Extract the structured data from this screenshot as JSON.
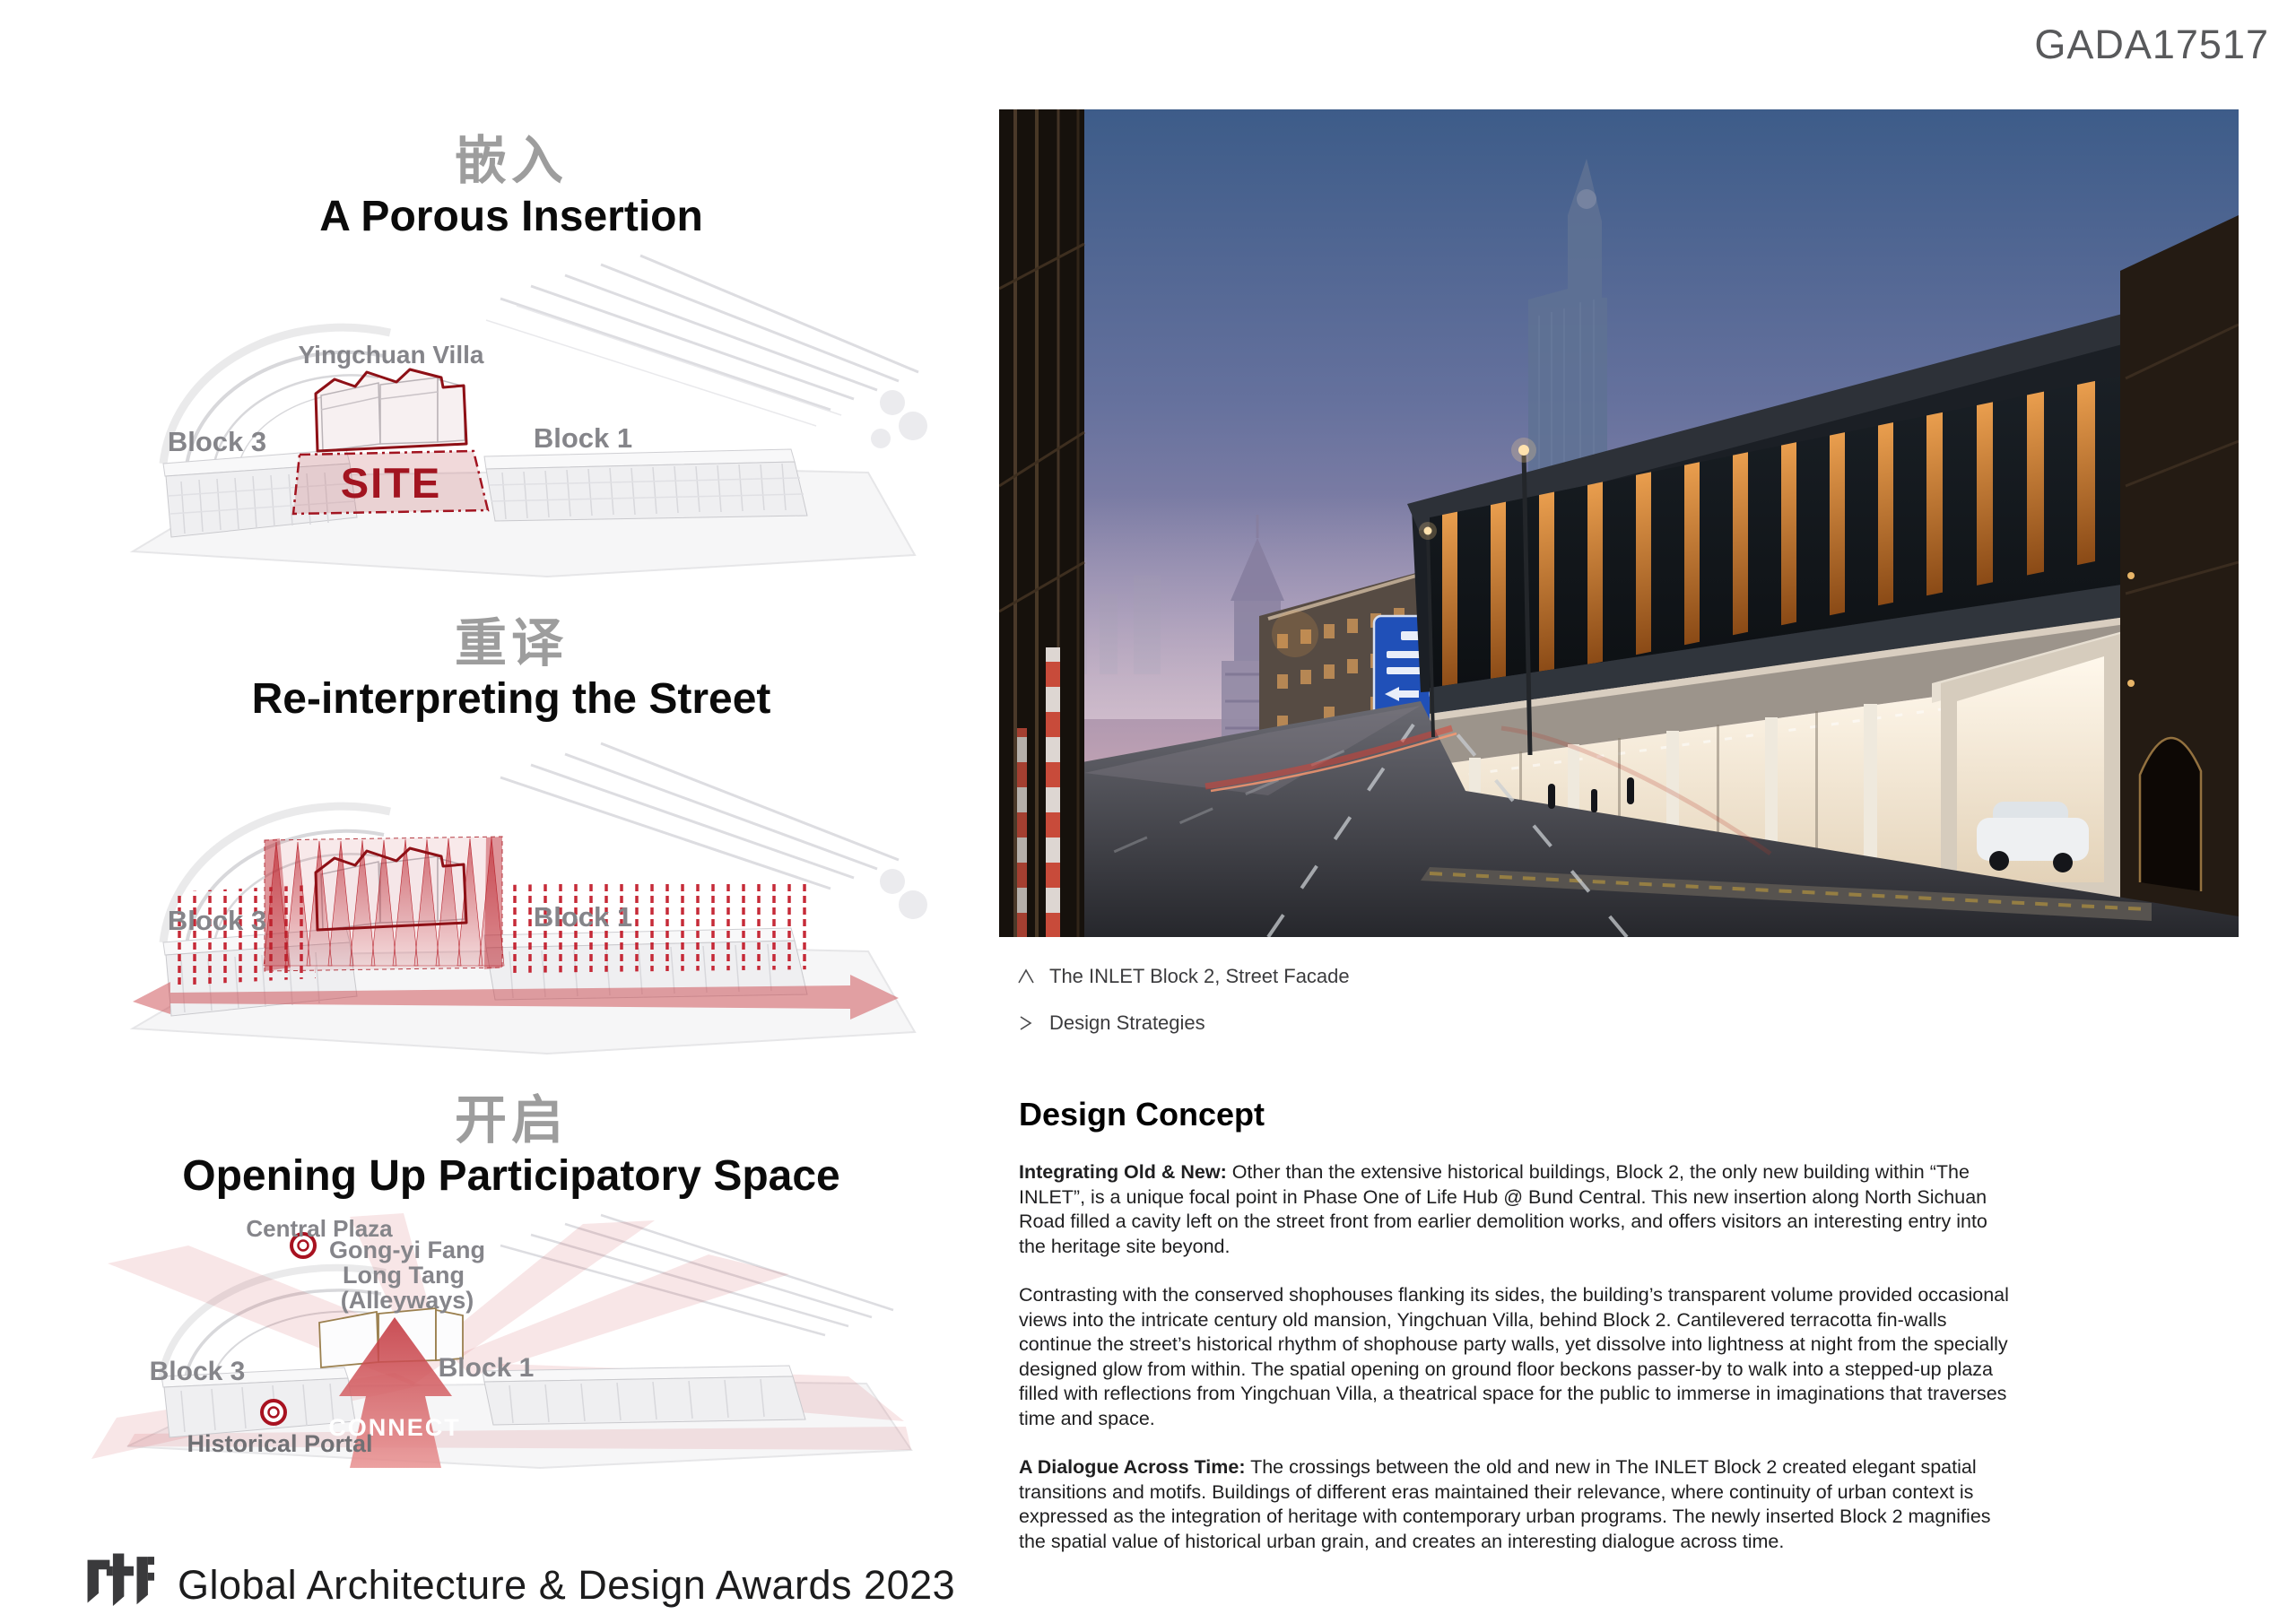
{
  "page": {
    "code": "GADA17517"
  },
  "sections": {
    "s1": {
      "zh": "嵌入",
      "en": "A Porous Insertion",
      "villa": "Yingchuan Villa",
      "block3": "Block 3",
      "block1": "Block 1",
      "site": "SITE"
    },
    "s2": {
      "zh": "重译",
      "en": "Re-interpreting the Street",
      "block3": "Block 3",
      "block1": "Block 1"
    },
    "s3": {
      "zh": "开启",
      "en": "Opening Up Participatory Space",
      "central_plaza": "Central Plaza",
      "gongyi_line1": "Gong-yi Fang",
      "gongyi_line2": "Long Tang",
      "gongyi_line3": "(Alleyways)",
      "block3": "Block 3",
      "block1": "Block 1",
      "connect": "CONNECT",
      "historical_portal": "Historical Portal"
    }
  },
  "captions": {
    "photo": "The INLET Block 2, Street Facade",
    "strategies": "Design Strategies"
  },
  "concept": {
    "heading": "Design Concept",
    "p1_lead": "Integrating Old & New:",
    "p1_body": " Other than the extensive historical buildings, Block 2, the only new building within “The INLET”, is a unique focal point in Phase One of Life Hub @ Bund Central. This new insertion along North Sichuan Road filled a cavity left on the street front from earlier demolition works, and offers visitors an interesting entry into the heritage site beyond.",
    "p2": "Contrasting with the conserved shophouses flanking its sides, the building’s transparent volume provided occasional views into the intricate century old mansion, Yingchuan Villa, behind Block 2.  Cantilevered terracotta fin-walls continue the street’s historical rhythm of shophouse party walls, yet dissolve into lightness at night from the specially designed glow from within. The spatial opening on ground floor beckons passer-by to walk into a stepped-up plaza filled with reflections from Yingchuan Villa, a theatrical space for the public to immerse in imaginations that traverses time and space.",
    "p3_lead": "A Dialogue Across Time:",
    "p3_body": " The crossings between the old and new in The INLET Block 2 created elegant spatial transitions and motifs. Buildings of different eras maintained their relevance, where continuity of urban context is expressed as the integration of heritage with contemporary urban programs. The newly inserted Block 2 magnifies the spatial value of historical urban grain, and creates an interesting dialogue across time."
  },
  "footer": {
    "logo": "rtf",
    "award": "Global Architecture & Design Awards 2023"
  },
  "colors": {
    "accent_red": "#a21420",
    "site_pink": "rgba(193,80,88,0.22)",
    "heading_gray": "#9d9d9d",
    "fin_orange": "#e09a4d",
    "sky_top": "#3d5c89",
    "code_gray": "#58595b"
  },
  "icons": {
    "caption_photo": "chevron-up-icon",
    "caption_strategies": "chevron-right-icon",
    "brand": "rtf-logo"
  }
}
